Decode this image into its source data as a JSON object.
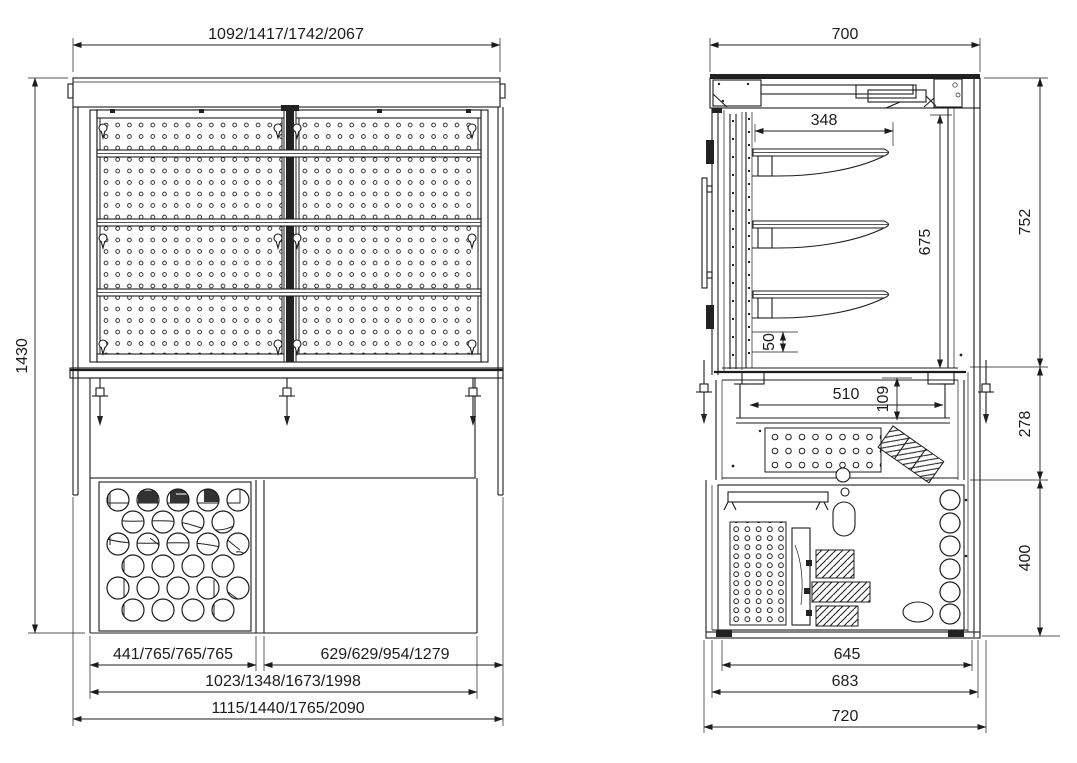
{
  "drawing": {
    "background_color": "#ffffff",
    "line_color": "#1c1c1c",
    "front_view": {
      "width_top": "1092/1417/1742/2067",
      "height_overall": "1430",
      "width_base_left": "441/765/765/765",
      "width_base_right": "629/629/954/1279",
      "width_base_inner": "1023/1348/1673/1998",
      "width_overall": "1115/1440/1765/2090"
    },
    "side_view": {
      "depth_top": "700",
      "shelf_depth": "348",
      "interior_height": "675",
      "shelf_gap": "50",
      "well_width": "510",
      "well_height": "109",
      "height_display": "752",
      "height_well": "278",
      "height_base": "400",
      "depth_base_inner": "645",
      "depth_base_mid": "683",
      "depth_overall": "720"
    }
  }
}
